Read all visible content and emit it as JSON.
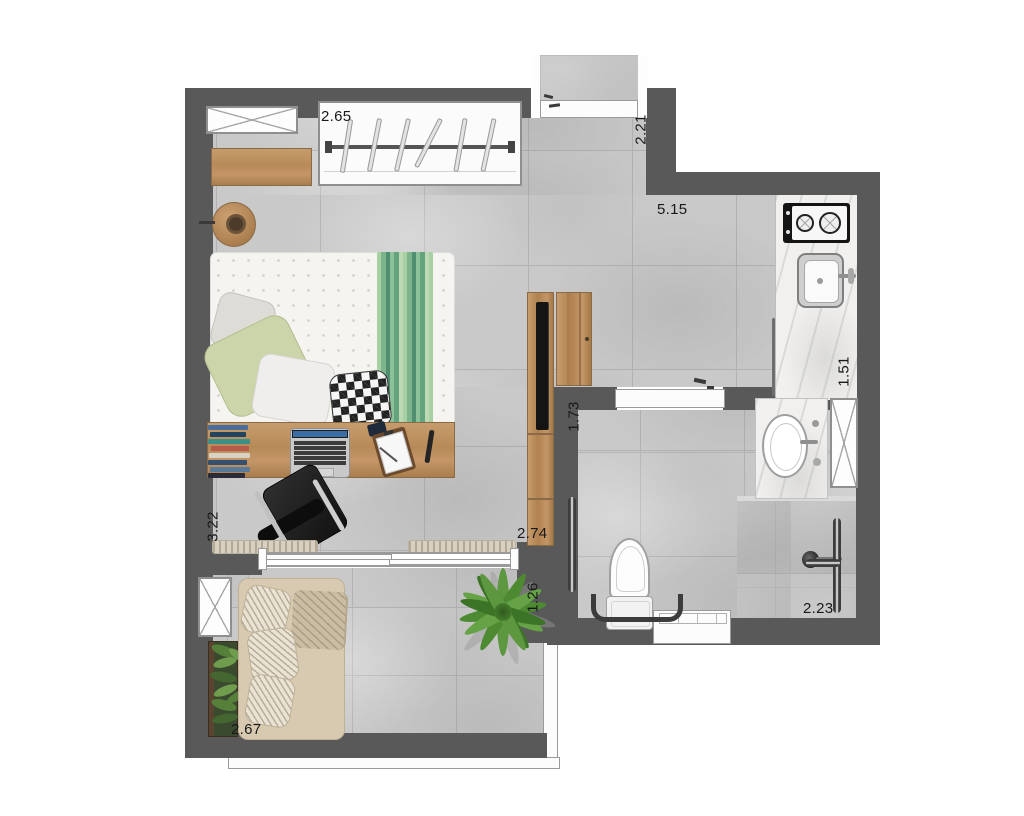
{
  "dimensions": {
    "wardrobe_width": "2.65",
    "entry_depth": "2.21",
    "living_length": "5.15",
    "kitchen_counter_length": "1.51",
    "bathroom_width": "1.73",
    "hall_width": "2.74",
    "bedroom_depth": "3.22",
    "balcony_depth": "1.26",
    "shower_width": "2.23",
    "balcony_width": "2.67"
  },
  "colors": {
    "wall": "#595959",
    "floor": "#c9c9c9",
    "grout": "#b2b2b2",
    "wood": "#b98a58",
    "counter_marble": "#f1f0ee",
    "bed_runner_green": "#6fae7e",
    "sofa_beige": "#d8cab0",
    "plant_green": "#4e8a31",
    "fixture_outline": "#9a9a9a",
    "grab_bar": "#3c3c3c"
  }
}
